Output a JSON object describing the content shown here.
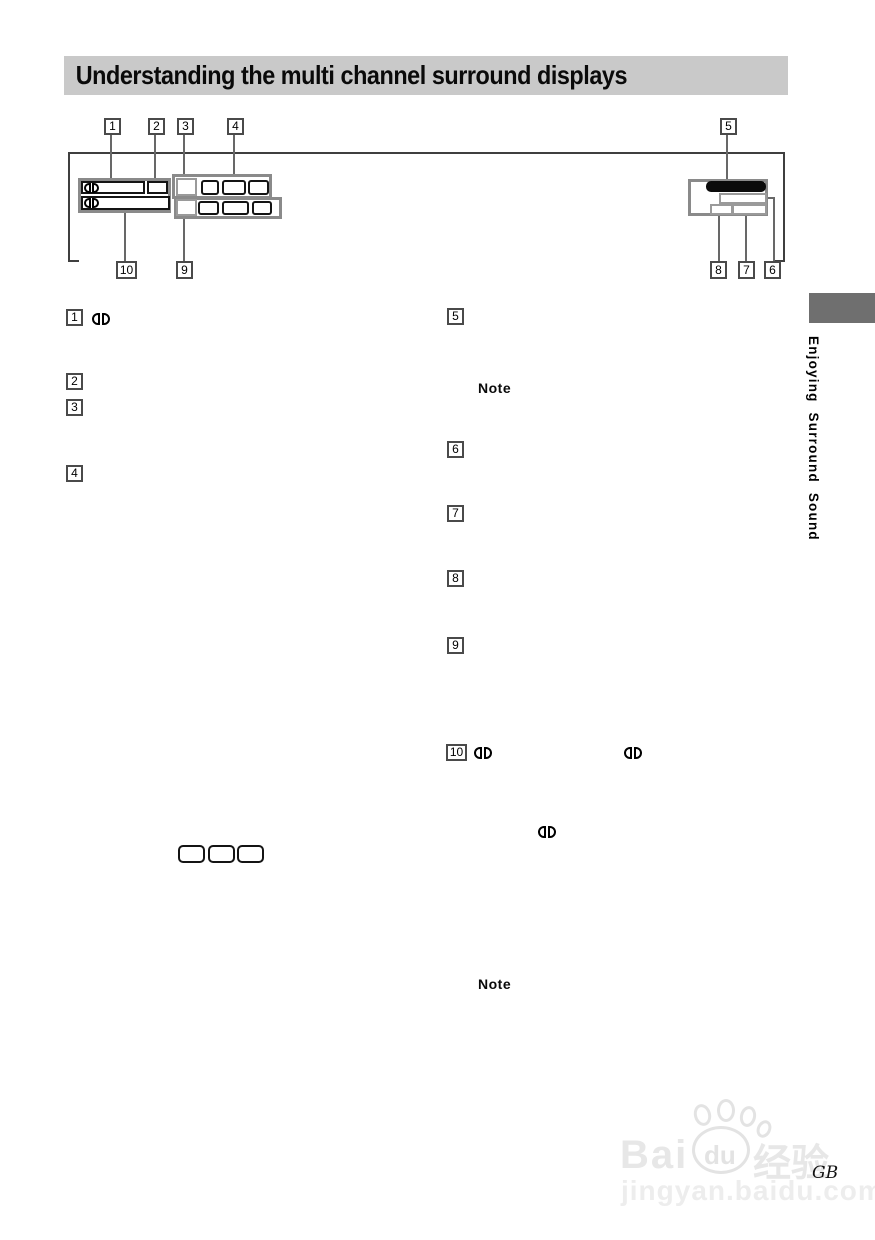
{
  "header": {
    "title": "Understanding the multi channel surround displays"
  },
  "sidebar": {
    "chapter": "Enjoying Surround Sound"
  },
  "callouts": {
    "n1": "1",
    "n2": "2",
    "n3": "3",
    "n4": "4",
    "n5": "5",
    "n6": "6",
    "n7": "7",
    "n8": "8",
    "n9": "9",
    "n10": "10"
  },
  "body": {
    "notes": {
      "first": "Note",
      "second": "Note"
    }
  },
  "icons": {
    "dolby": "dolby-digital-double-d-logo",
    "paw": "baidu-paw-icon"
  },
  "footer": {
    "page_code": "GB"
  },
  "watermark": {
    "bai": "Bai",
    "du": "du",
    "cn": "经验",
    "site": "jingyan.baidu.com"
  },
  "colors": {
    "header_bg": "#c9c9c9",
    "chapter_tab_gray": "#6f6f6f",
    "panel_border_gray": "#8a8a8a",
    "cell_border_black": "#141414",
    "cell_border_gray": "#9a9a9a",
    "display_pill_black": "#0b0b0b",
    "watermark_gray": "#e7e7e7"
  }
}
